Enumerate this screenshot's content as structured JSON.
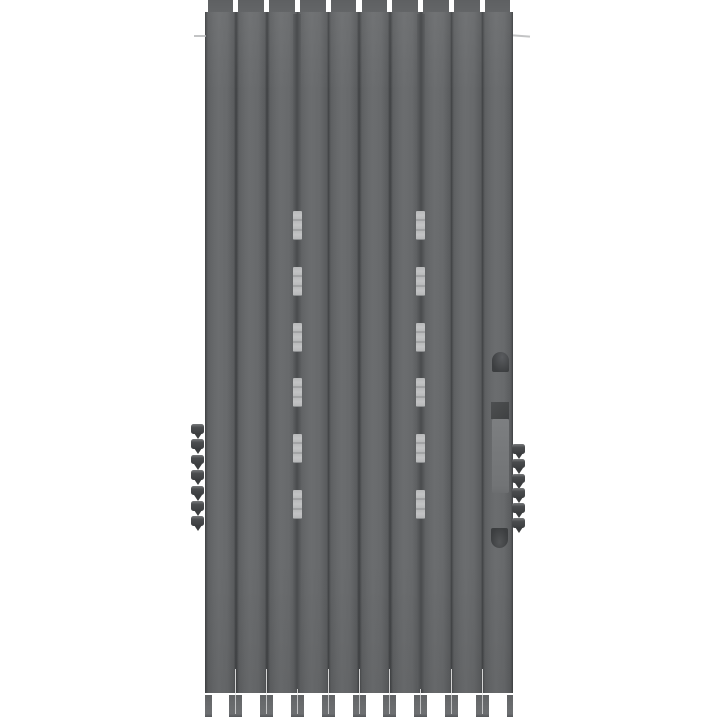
{
  "scene": {
    "description": "3D render of a tall gray accordion folding shutter door, viewed front-on against a white background",
    "object_type": "folding-shutter-door",
    "background_color": "#ffffff"
  },
  "door": {
    "panel_count": 10,
    "body_color": "#67696b",
    "seam_color": "#3f4143",
    "panel_highlight_color": "#6b6d6f",
    "panel_shadow_color": "#5a5c5e",
    "geometry": {
      "left": 205,
      "top": 12,
      "width": 308,
      "height": 681,
      "tab_height": 12,
      "tab_inset": 2.5,
      "foot_top": 695,
      "foot_height": 22,
      "foot_width": 13
    }
  },
  "hinges": {
    "column_boundary_indices": [
      3,
      7
    ],
    "channel_color": "#5d5f61",
    "channel_center_color": "#4a4c4e",
    "knuckle_color": "#b7b8b9",
    "knuckle_separator_color": "#8b8d8f",
    "group_count": 6,
    "segments_per_group": 3,
    "first_group_y": 211,
    "group_spacing": 55.8,
    "group_height": 29,
    "knuckle_width": 9
  },
  "teeth": {
    "head_color": "#3f4143",
    "point_color": "#3b3d3f",
    "left": {
      "count": 7,
      "x": 191,
      "y_start": 424,
      "spacing": 15.4,
      "width": 13
    },
    "right": {
      "count": 6,
      "x": 512,
      "y_start": 444,
      "spacing": 14.8,
      "width": 13
    }
  },
  "handle": {
    "top_cup": {
      "x": 492,
      "y": 352,
      "w": 17,
      "h": 20,
      "color": "#3c3e40",
      "highlight": "#5a5c5f"
    },
    "latch_square": {
      "x": 491,
      "y": 402,
      "w": 18,
      "h": 17,
      "color": "#454748"
    },
    "recess_strip": {
      "x": 492,
      "y": 419,
      "w": 17,
      "h": 74,
      "color": "#77797b"
    },
    "bottom_cup": {
      "x": 491,
      "y": 528,
      "w": 17,
      "h": 20,
      "color": "#3c3e40"
    }
  },
  "tick_marks": {
    "color": "#b4b5b6",
    "left": {
      "x": 194,
      "y": 35,
      "w": 12
    },
    "right": {
      "x": 513,
      "y": 35,
      "w": 17
    }
  },
  "bottom_gap_slit_color": "#ededed"
}
